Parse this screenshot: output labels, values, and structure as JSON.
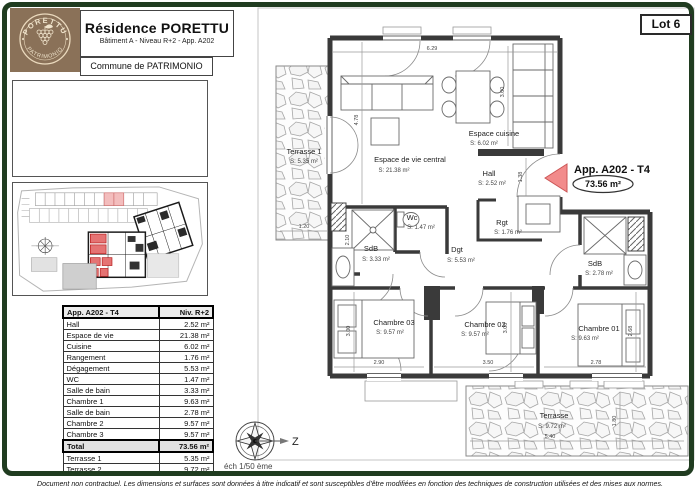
{
  "header": {
    "logo": {
      "arc_top": "PORETTU",
      "arc_bottom": "PATRIMONIO",
      "bg_color": "#8a7158",
      "text_color": "#f0e4cc"
    },
    "title": "Résidence PORETTU",
    "subtitle": "Bâtiment A - Niveau R+2 - App. A202",
    "commune": "Commune de PATRIMONIO",
    "lot_label": "Lot 6"
  },
  "areas_table": {
    "header_left": "App. A202 - T4",
    "header_right": "Niv. R+2",
    "rows": [
      {
        "label": "Hall",
        "value": "2.52 m²"
      },
      {
        "label": "Espace de vie",
        "value": "21.38 m²"
      },
      {
        "label": "Cuisine",
        "value": "6.02 m²"
      },
      {
        "label": "Rangement",
        "value": "1.76 m²"
      },
      {
        "label": "Dégagement",
        "value": "5.53 m²"
      },
      {
        "label": "WC",
        "value": "1.47 m²"
      },
      {
        "label": "Salle de bain",
        "value": "3.33 m²"
      },
      {
        "label": "Chambre 1",
        "value": "9.63 m²"
      },
      {
        "label": "Salle de bain",
        "value": "2.78 m²"
      },
      {
        "label": "Chambre 2",
        "value": "9.57 m²"
      },
      {
        "label": "Chambre 3",
        "value": "9.57 m²"
      }
    ],
    "total_label": "Total",
    "total_value": "73.56 m²",
    "extra_rows": [
      {
        "label": "Terrasse 1",
        "value": "5.35 m²"
      },
      {
        "label": "Terrasse 2",
        "value": "9.72 m²"
      }
    ]
  },
  "plan": {
    "apartment_label": "App. A202 - T4",
    "apartment_area": "73.56 m²",
    "callout_color": "#f28b8b",
    "rooms": [
      {
        "name": "Terrasse 1",
        "area": "S: 5.35 m²"
      },
      {
        "name": "Espace de vie central",
        "area": "S: 21.38 m²"
      },
      {
        "name": "Espace cuisine",
        "area": "S: 6.02 m²"
      },
      {
        "name": "Hall",
        "area": "S: 2.52 m²"
      },
      {
        "name": "Wc",
        "area": "S: 1.47 m²"
      },
      {
        "name": "SdB",
        "area": "S: 3.33 m²"
      },
      {
        "name": "Dgt",
        "area": "S: 5.53 m²"
      },
      {
        "name": "Rgt",
        "area": "S: 1.76 m²"
      },
      {
        "name": "SdB",
        "area": "S: 2.78 m²"
      },
      {
        "name": "Chambre 03",
        "area": "S: 9.57 m²"
      },
      {
        "name": "Chambre 02",
        "area": "S: 9.57 m²"
      },
      {
        "name": "Chambre 01",
        "area": "S: 9.63 m²"
      },
      {
        "name": "Terrasse",
        "area": "S: 9.72 m²"
      }
    ],
    "dimensions": [
      "6.29",
      "4.78",
      "3.00",
      "1.38",
      "1.20",
      "2.10",
      "3.00",
      "2.90",
      "3.00",
      "3.50",
      "2.68",
      "2.78",
      "5.40",
      "1.80"
    ]
  },
  "compass": {
    "label": "Z"
  },
  "scale_label": "éch 1/50 ème",
  "footer_disclaimer": "Document non contractuel. Les dimensions et surfaces sont données à titre indicatif et sont susceptibles d'être modifiées en fonction des techniques de construction utilisées et des mises aux normes."
}
